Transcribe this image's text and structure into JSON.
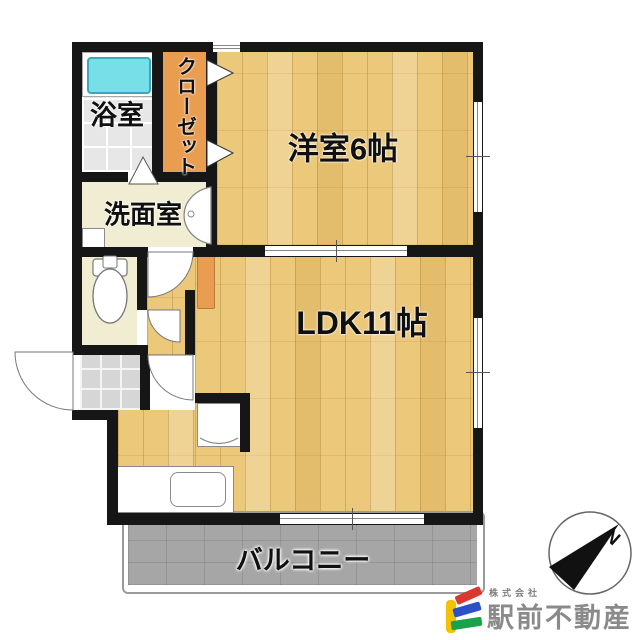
{
  "plan": {
    "rooms": {
      "bathroom": {
        "label": "浴室"
      },
      "closet": {
        "label": "クローゼット"
      },
      "washroom": {
        "label": "洗面室"
      },
      "western_room": {
        "label": "洋室6帖",
        "size_jo": "6帖"
      },
      "ldk": {
        "label": "LDK11帖",
        "size_jo": "11帖"
      },
      "balcony": {
        "label": "バルコニー"
      }
    }
  },
  "compass": {
    "north_label": "N"
  },
  "logo": {
    "company_type": "株式会社",
    "company_name": "駅前不動産"
  },
  "colors": {
    "wall": "#161616",
    "wood_floor": "#ebc87a",
    "closet_orange": "#e99d51",
    "washroom_cream": "#f0edd2",
    "bathtub_cyan": "#76dfe8",
    "balcony_gray": "#a6a6a6",
    "entrance_tile_gray": "#d6d6d6",
    "logo_yellow": "#f2c100",
    "logo_red": "#d93a30",
    "logo_blue": "#2b50c8",
    "logo_green": "#19a24a",
    "logo_text_gray": "#8a8a8a"
  }
}
